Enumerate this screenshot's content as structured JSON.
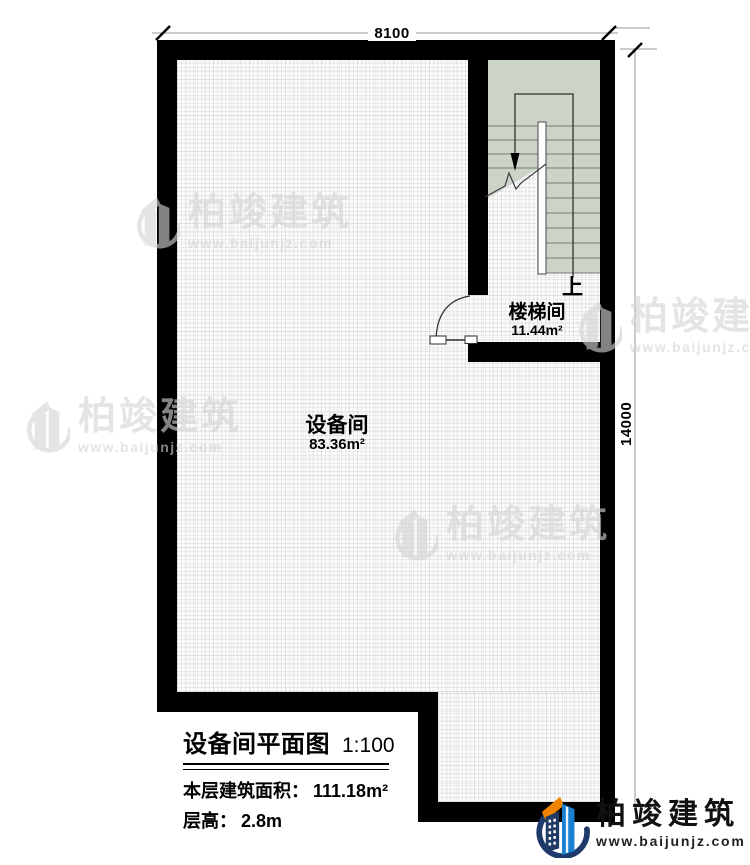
{
  "dimensions": {
    "top": "8100",
    "right": "14000"
  },
  "rooms": [
    {
      "id": "equipment-room",
      "name": "设备间",
      "area": "83.36m²"
    },
    {
      "id": "stairwell",
      "name": "楼梯间",
      "area": "11.44m²"
    }
  ],
  "stair": {
    "up_label": "上"
  },
  "title_block": {
    "title": "设备间平面图",
    "scale": "1:100",
    "area_label": "本层建筑面积：",
    "area_value": "111.18m²",
    "floor_height_label": "层高：",
    "floor_height_value": "2.8m"
  },
  "watermark": {
    "name": "柏竣建筑",
    "url": "www.baijunjz.com"
  },
  "logo": {
    "name": "柏竣建筑",
    "url": "www.baijunjz.com"
  },
  "colors": {
    "wall": "#000000",
    "stair_fill": "#ccd4c8",
    "logo_navy": "#1d3a6b",
    "logo_blue": "#1b7fd0",
    "logo_orange": "#f08300",
    "watermark_gray": "#d4d4d4"
  }
}
